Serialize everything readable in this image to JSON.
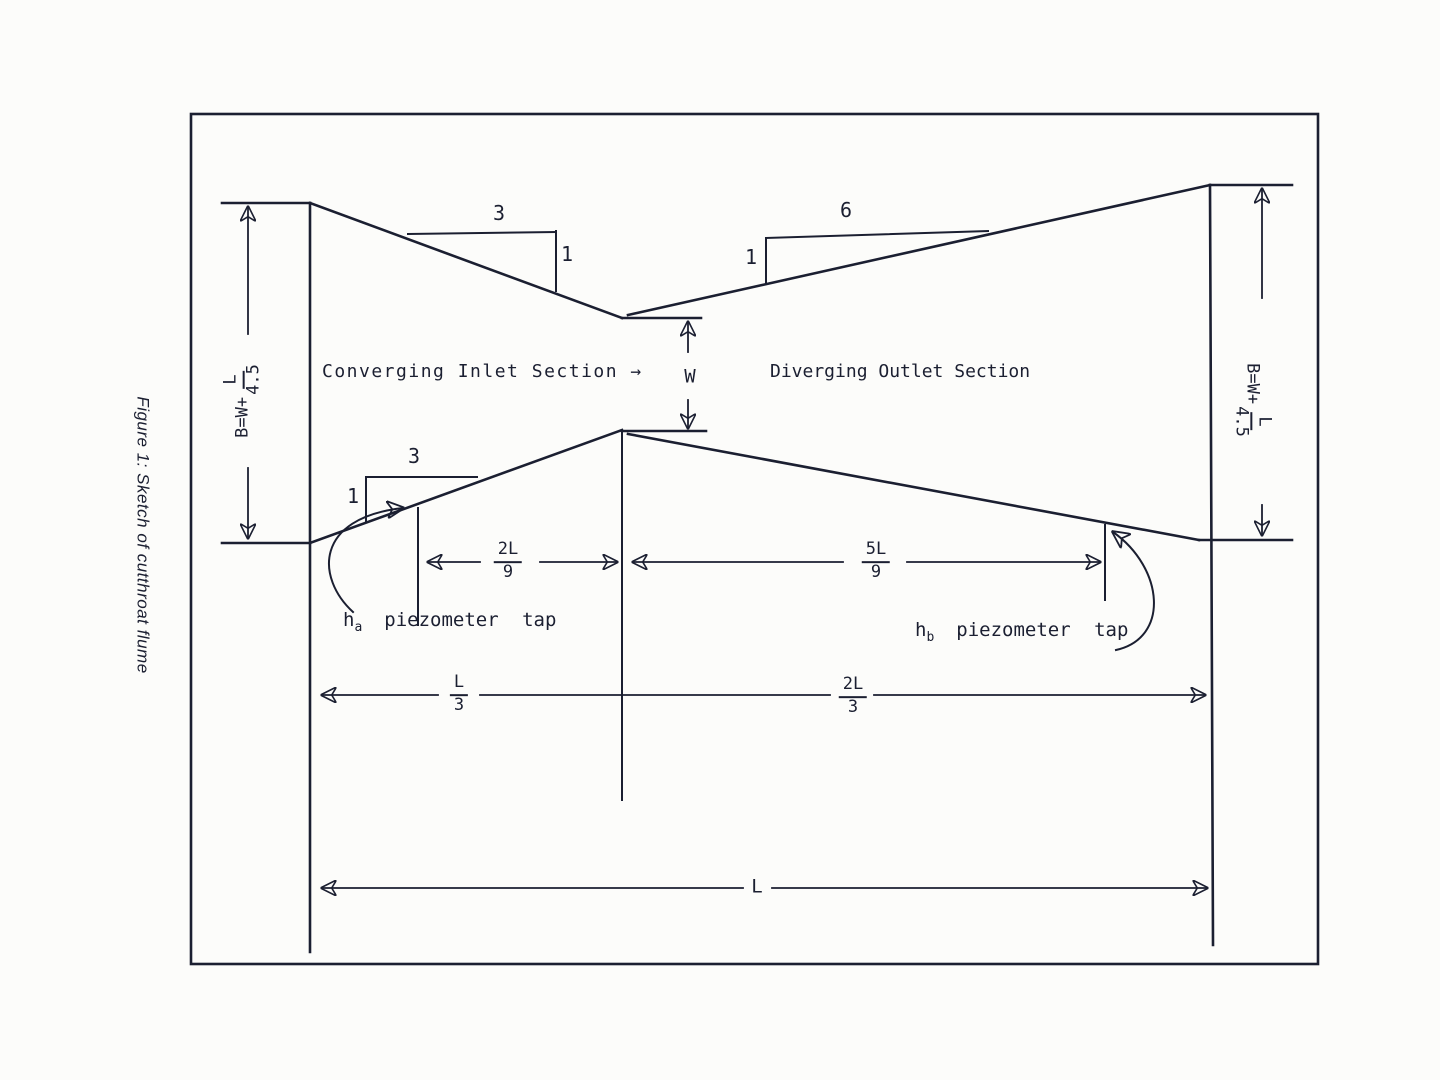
{
  "colors": {
    "ink": "#1b1f31",
    "paper": "#fcfcfa"
  },
  "figure": {
    "caption": "Figure 1: Sketch of cutthroat flume"
  },
  "sections": {
    "converging": "Converging Inlet Section →",
    "diverging": "Diverging Outlet Section"
  },
  "throat": {
    "width_label": "W"
  },
  "side_dimensions": {
    "left": {
      "expr": "B=W+",
      "frac_num": "L",
      "frac_den": "4.5"
    },
    "right": {
      "expr": "B=W+",
      "frac_num": "L",
      "frac_den": "4.5"
    }
  },
  "slopes": {
    "inlet_top": {
      "run": "3",
      "rise": "1"
    },
    "outlet_top": {
      "run": "6",
      "rise": "1"
    },
    "inlet_bottom": {
      "run": "3",
      "rise": "1"
    }
  },
  "dimensions": {
    "inlet_tap": {
      "num": "2L",
      "den": "9"
    },
    "outlet_tap": {
      "num": "5L",
      "den": "9"
    },
    "inlet_length": {
      "num": "L",
      "den": "3"
    },
    "outlet_length": {
      "num": "2L",
      "den": "3"
    },
    "total_length": "L"
  },
  "piezometers": {
    "ha": {
      "sym": "h",
      "sub": "a",
      "label": "piezometer tap"
    },
    "hb": {
      "sym": "h",
      "sub": "b",
      "label": "piezometer tap"
    }
  }
}
